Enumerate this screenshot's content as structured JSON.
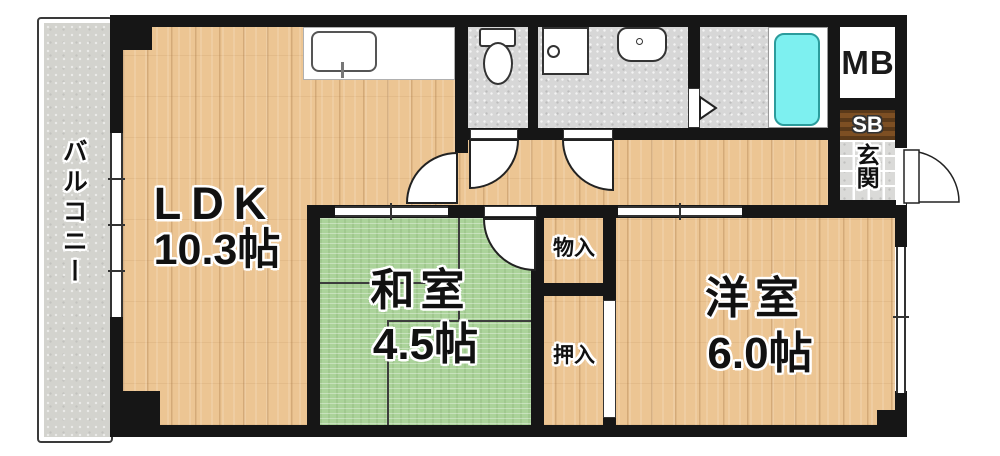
{
  "plan_title": "2DK floor plan",
  "rooms": {
    "balcony": {
      "label": "バルコニー"
    },
    "ldk": {
      "label": "LDK",
      "size": "10.3帖"
    },
    "japanese_room": {
      "label": "和室",
      "size": "4.5帖"
    },
    "western_room": {
      "label": "洋室",
      "size": "6.0帖"
    },
    "storage": {
      "label": "物入"
    },
    "closet": {
      "label": "押入"
    },
    "entrance": {
      "label": "玄関"
    },
    "shoe_box": {
      "label": "SB"
    },
    "meter_box": {
      "label": "MB"
    }
  },
  "colors": {
    "wall": "#161616",
    "wood_floor": "#ecc593",
    "tatami": "#abd39a",
    "wet_floor": "#d7d7d7",
    "tile_floor": "#dadad8",
    "balcony_floor": "#d3d3ce",
    "shoe_box_brown": "#7d4f23",
    "bathtub": "#7df0f0"
  }
}
